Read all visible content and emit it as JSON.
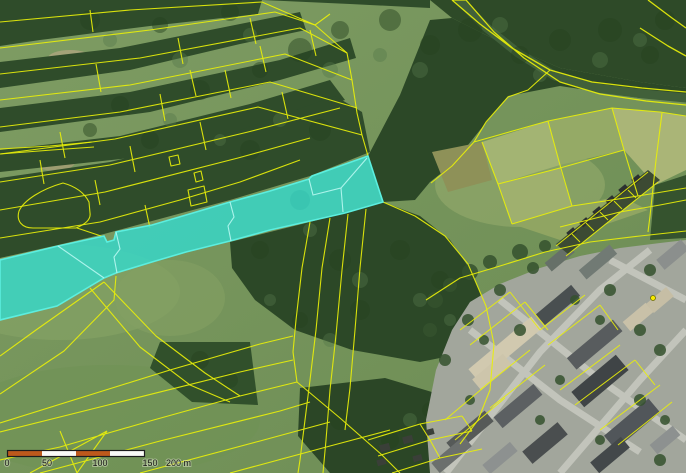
{
  "map": {
    "highlight": {
      "fill": "#36d8ca",
      "fill_opacity": "0.82",
      "stroke": "#5ceedf",
      "divider_stroke": "#b2f6ee"
    },
    "parcel_line_color": "#e8ef0a",
    "marker_color": "#f6ea00"
  },
  "scalebar": {
    "labels": [
      "0",
      "50",
      "100",
      "150",
      "200 m"
    ],
    "segment_colors": {
      "odd": "#bd591c",
      "even": "#fafaf7"
    },
    "border_color": "#1d1d1d",
    "text_color": "#161616"
  }
}
